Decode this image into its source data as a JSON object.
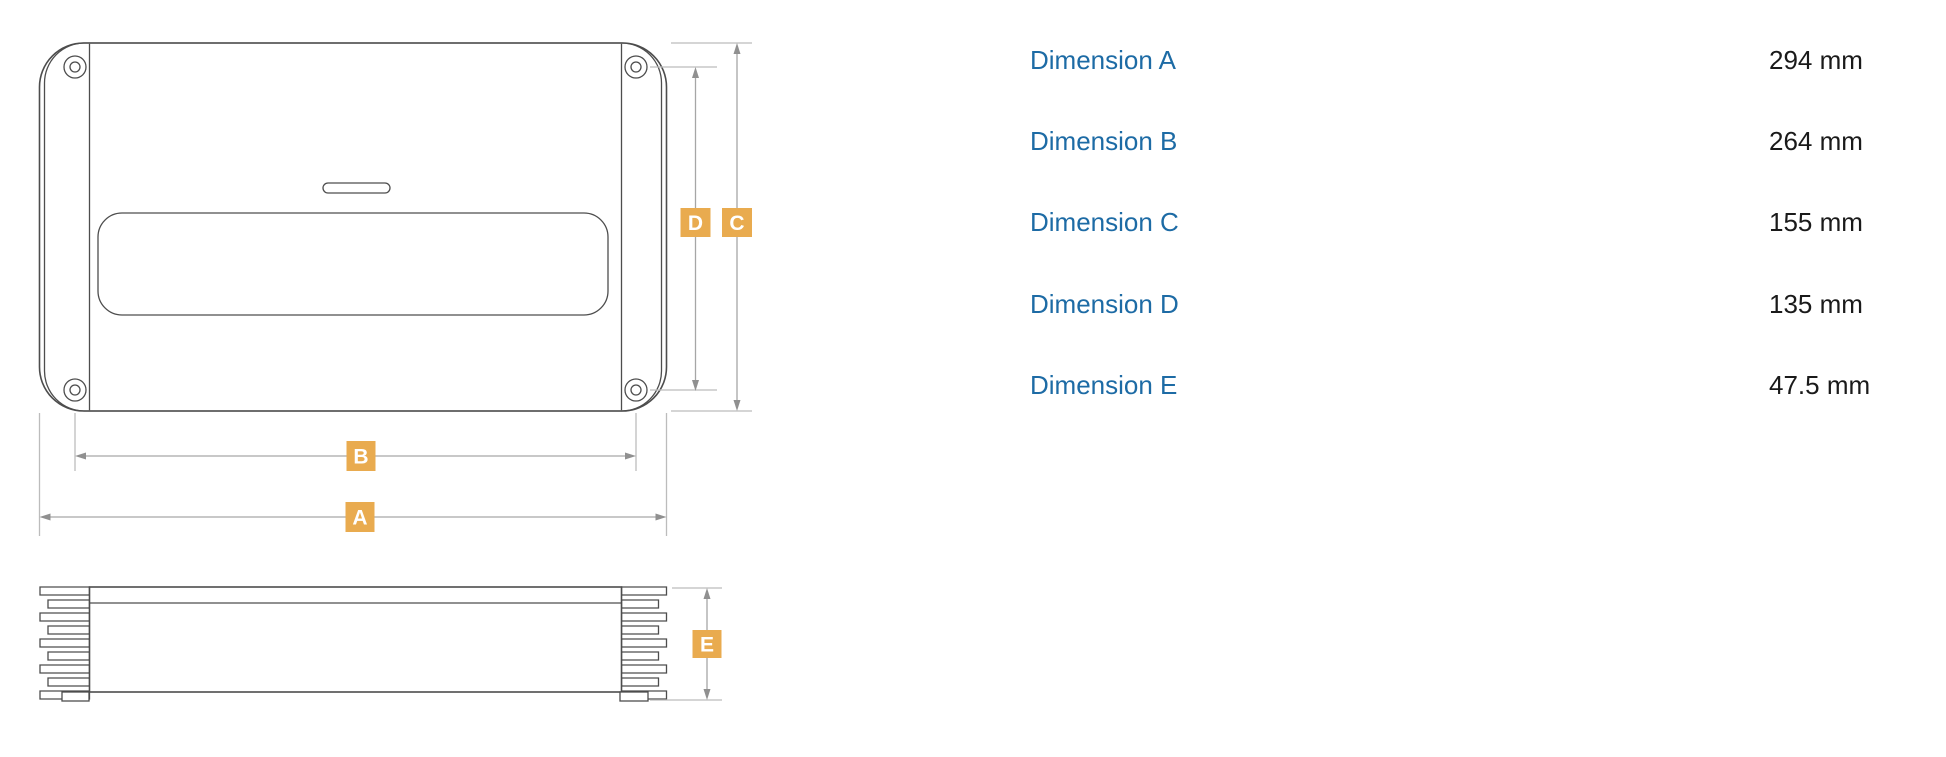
{
  "diagram": {
    "markers": [
      {
        "letter": "D"
      },
      {
        "letter": "C"
      },
      {
        "letter": "B"
      },
      {
        "letter": "A"
      },
      {
        "letter": "E"
      }
    ],
    "marker_color": "#e9ab4f",
    "marker_text_color": "#ffffff",
    "outline_color": "#4d4d4d",
    "dimension_line_color": "#a6a6a6"
  },
  "table": {
    "label_color": "#1d6ba5",
    "value_color": "#1a1a1a",
    "rows": [
      {
        "label": "Dimension A",
        "value": "294 mm"
      },
      {
        "label": "Dimension B",
        "value": "264 mm"
      },
      {
        "label": "Dimension C",
        "value": "155 mm"
      },
      {
        "label": "Dimension D",
        "value": "135 mm"
      },
      {
        "label": "Dimension E",
        "value": "47.5 mm"
      }
    ]
  }
}
